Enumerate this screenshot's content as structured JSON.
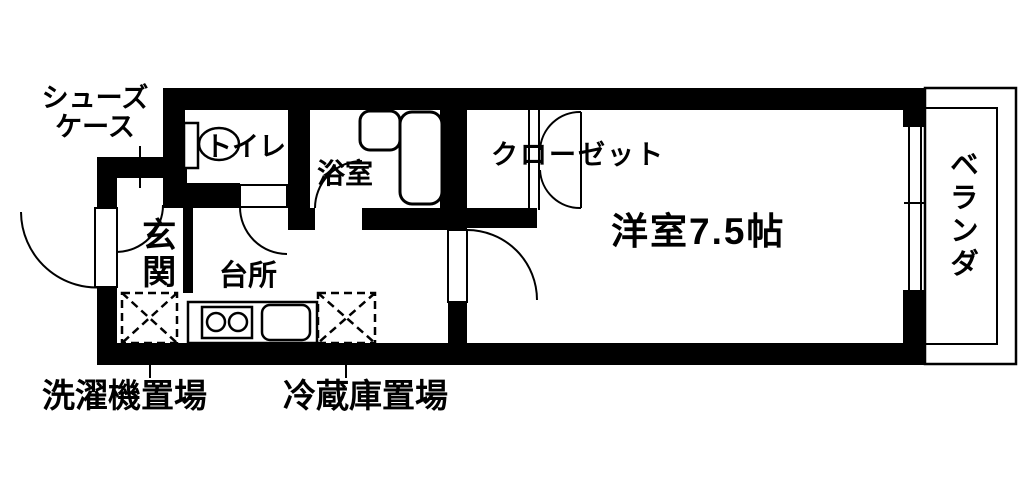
{
  "title": "ワンルーム間取り図",
  "colors": {
    "wall": "#000000",
    "line": "#000000",
    "background": "#ffffff"
  },
  "rooms": {
    "shoe_case": {
      "label_line1": "シューズ",
      "label_line2": "ケース"
    },
    "toilet": {
      "label": "トイレ"
    },
    "bathroom": {
      "label": "浴室"
    },
    "closet": {
      "label": "クローゼット"
    },
    "western_room": {
      "label": "洋室7.5帖",
      "size_tatami": "7.5"
    },
    "entrance": {
      "label": "玄関"
    },
    "kitchen": {
      "label": "台所"
    },
    "veranda": {
      "label": "ベランダ"
    },
    "washer_space": {
      "label": "洗濯機置場"
    },
    "fridge_space": {
      "label": "冷蔵庫置場"
    }
  }
}
